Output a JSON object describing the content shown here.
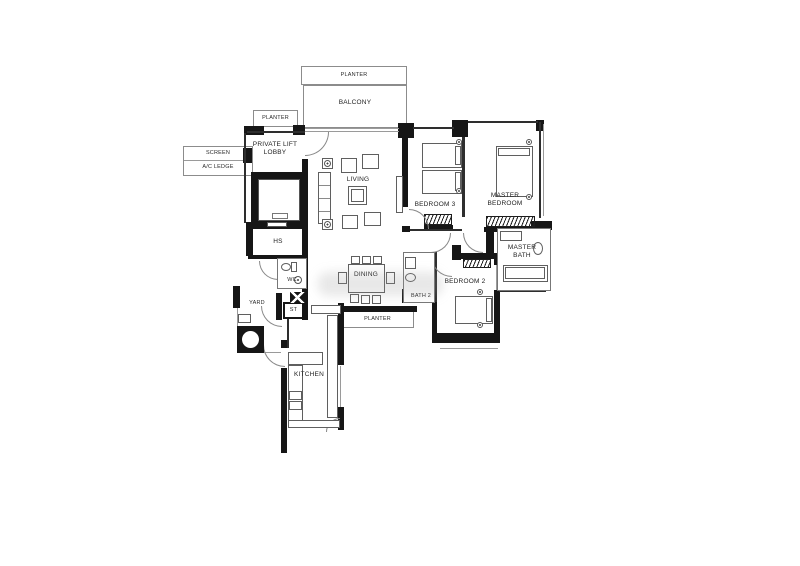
{
  "labels": {
    "planter_top": "PLANTER",
    "balcony": "BALCONY",
    "planter_left": "PLANTER",
    "screen": "SCREEN",
    "ac_ledge": "A/C LEDGE",
    "private_lift_lobby": "PRIVATE LIFT LOBBY",
    "living": "LIVING",
    "bedroom3": "BEDROOM 3",
    "master_bedroom": "MASTER BEDROOM",
    "master_bath": "MASTER BATH",
    "hs": "HS",
    "wc": "WC",
    "yard": "YARD",
    "st": "ST",
    "dining": "DINING",
    "bath2": "BATH 2",
    "bedroom2": "BEDROOM 2",
    "planter_bottom": "PLANTER",
    "kitchen": "KITCHEN"
  },
  "colors": {
    "wall": "#161616",
    "line": "#8c8c8c",
    "text": "#222222",
    "background": "#ffffff"
  }
}
